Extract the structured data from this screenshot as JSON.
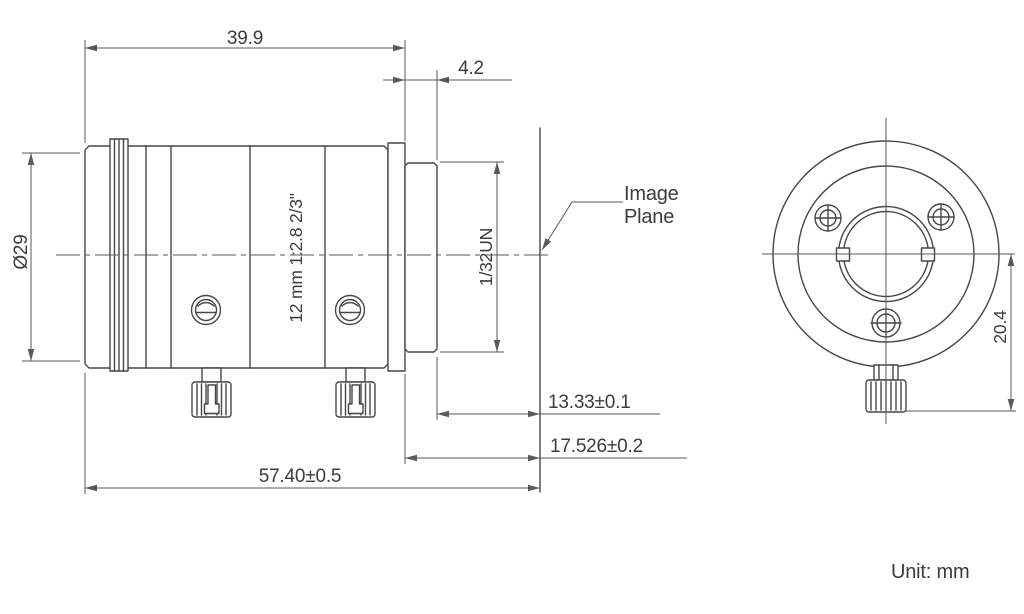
{
  "drawing": {
    "unit_label": "Unit: mm",
    "side_view": {
      "lens_spec": "12 mm 1:2.8 2/3\"",
      "thread_spec": "1/32UN",
      "image_plane_line1": "Image",
      "image_plane_line2": "Plane",
      "dims": {
        "front_to_flange": "39.9",
        "thread_length": "4.2",
        "outer_diameter": "Ø29",
        "thread_to_image_plane": "13.33±0.1",
        "flange_to_image_plane": "17.526±0.2",
        "front_to_image_plane": "57.40±0.5"
      }
    },
    "rear_view": {
      "dims": {
        "center_to_lock_screw": "20.4"
      }
    }
  }
}
